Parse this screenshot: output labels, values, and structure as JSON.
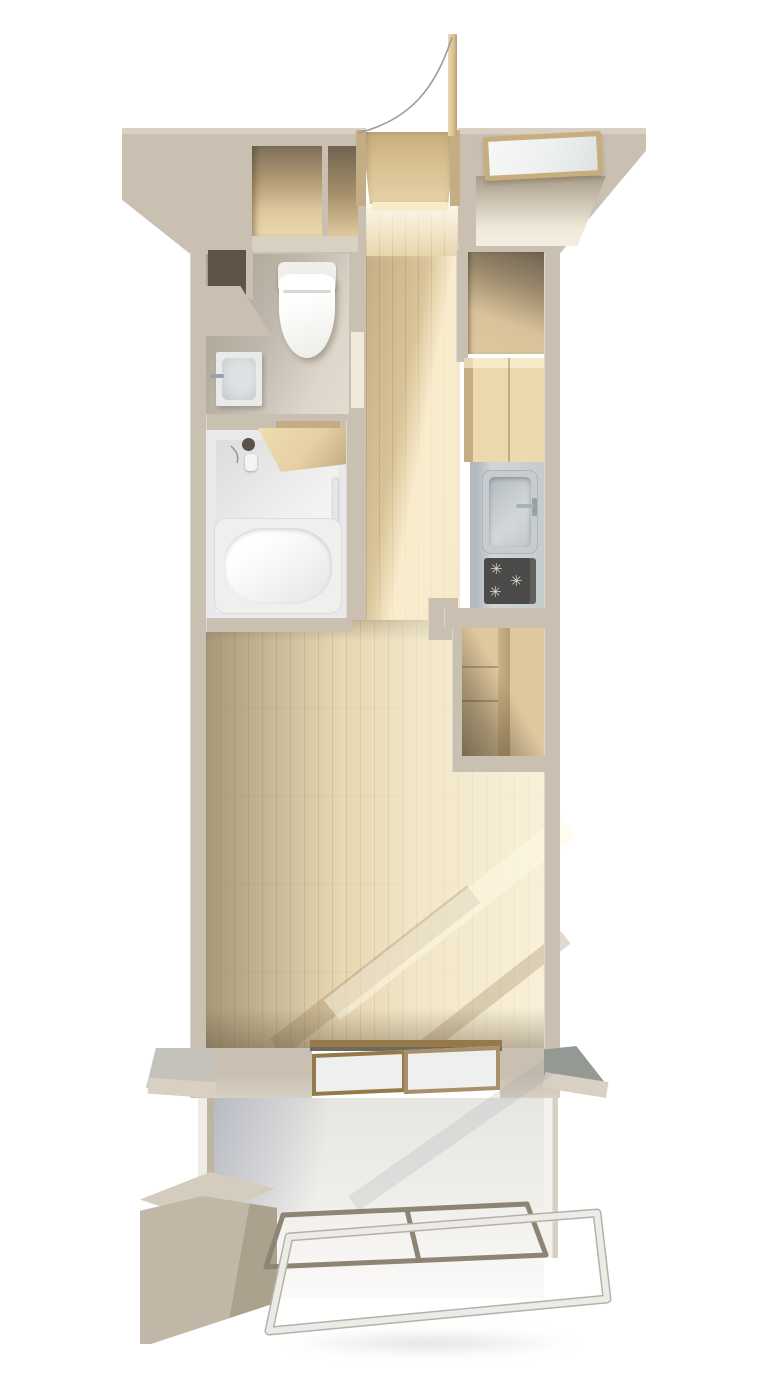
{
  "colors": {
    "bg": "#ffffff",
    "wall": "#c9c0b1",
    "wall-light": "#d8d0c2",
    "wall-shadow": "#a89c89",
    "wall-front": "#beb4a2",
    "wood-closet": "#dfc89e",
    "wood-hall": "#e6d0a3",
    "wood-living": "#e8d8b3",
    "wood-sun": "#f7ebc9",
    "wood-dark": "#c4ad85",
    "wood-deep": "#7e7059",
    "genkan": "#d6bd8f",
    "door-leaf": "#d8c294",
    "toilet-floor-a": "#a79e90",
    "toilet-floor-b": "#e3ddd1",
    "bath-wall": "#e9e9ec",
    "steel": "#d2d6d9",
    "steel-dark": "#b3b9be",
    "stove": "#4b4a48",
    "burner": "#d6d5d2",
    "glass": "#eef0f0",
    "frame-bronze": "#96794a",
    "frame-wood": "#c8ad7f",
    "eave-gray": "#c5c2bc",
    "eave-green": "#949a93",
    "rail-metal": "#8d8473",
    "rail-white": "#edebe7",
    "balcony": "#efede9",
    "box-top": "#d4ccbd",
    "box-front": "#c0b7a6",
    "box-side": "#aca18d",
    "arc": "#9b9b9b"
  },
  "glyphs": {
    "burner": "✳"
  },
  "fixtures": [
    "entrance-door",
    "door-swing-arc",
    "genkan-floor",
    "shoe-closet",
    "storage-room",
    "storage-window",
    "toilet",
    "hand-basin",
    "wall-niche",
    "unit-bath",
    "bathtub",
    "shower-head",
    "towel-bar",
    "bath-counter",
    "hallway-floor",
    "upper-closet",
    "kitchen-cabinet",
    "kitchen-sink",
    "gas-stove",
    "living-closet",
    "living-room-floor",
    "sliding-window",
    "left-eave",
    "right-eave",
    "balcony-floor",
    "balcony-railing",
    "utility-box"
  ]
}
